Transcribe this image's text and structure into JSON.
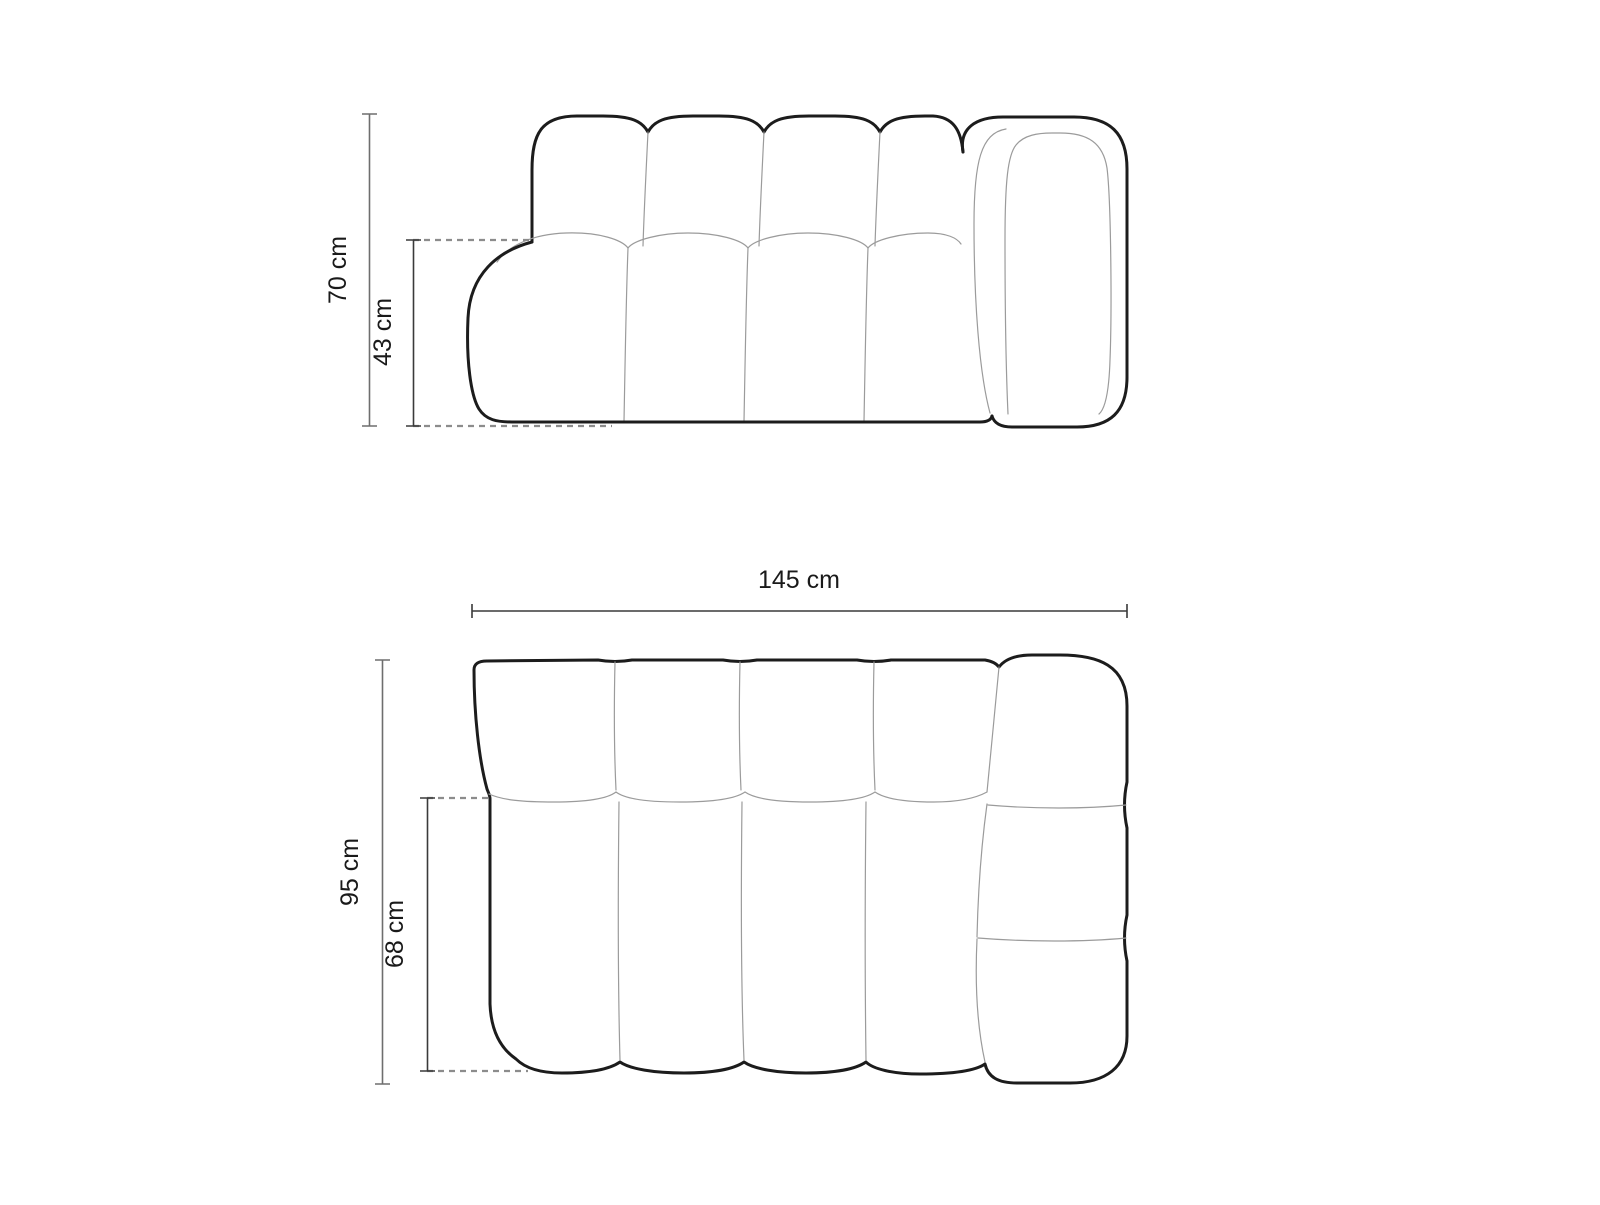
{
  "diagram": {
    "kind": "furniture dimension drawing",
    "subject": "modular sofa with right-hand armrest, front elevation and top plan",
    "front_view": {
      "name": "front elevation",
      "total_height": {
        "label": "70 cm",
        "value": 70,
        "unit": "cm",
        "orientation": "vertical"
      },
      "seat_height": {
        "label": "43 cm",
        "value": 43,
        "unit": "cm",
        "orientation": "vertical"
      }
    },
    "plan_view": {
      "name": "top plan",
      "total_width": {
        "label": "145 cm",
        "value": 145,
        "unit": "cm",
        "orientation": "horizontal"
      },
      "total_depth": {
        "label": "95 cm",
        "value": 95,
        "unit": "cm",
        "orientation": "vertical"
      },
      "seat_depth": {
        "label": "68 cm",
        "value": 68,
        "unit": "cm",
        "orientation": "vertical"
      }
    },
    "colors": {
      "outline": "#1c1c1c",
      "inner_line": "#9b9b9b",
      "dimension_dark": "#3a3a3a",
      "dimension_light": "#6e6e6e",
      "dashed_line": "#8c8c8c",
      "text": "#1a1a1a",
      "background": "#ffffff"
    }
  }
}
